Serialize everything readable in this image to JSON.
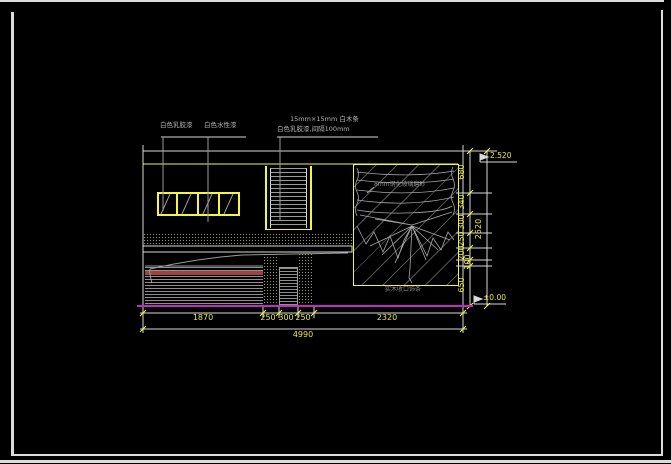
{
  "annotations": {
    "finish_label_1": "白色乳胶漆",
    "finish_label_2": "白色水性漆",
    "wood_strip_note_line1": "15mm×15mm 白木条",
    "wood_strip_note_line2": "白色乳胶漆,间隔100mm",
    "panel_note": "8mm钢化玻璃磨砂",
    "panel_bottom_note": "实木收口饰条"
  },
  "levels": {
    "top": "2.520",
    "bottom": "±0.00"
  },
  "dimensions": {
    "bottom_chain": [
      "1870",
      "250",
      "300",
      "250",
      "2320"
    ],
    "bottom_total": "4990",
    "right_chain": [
      "680",
      "340",
      "300",
      "250",
      "200",
      "100",
      "650"
    ],
    "right_total": "2520"
  },
  "colors": {
    "background": "#000000",
    "frame": "#dcdcdc",
    "cad_yellow": "#f5f53e",
    "dim_text_yellow": "#e8e83c",
    "detail_gray": "#9a9a9a",
    "ground_magenta": "#c828c8",
    "shutter_red_stripe": "#a04040"
  }
}
